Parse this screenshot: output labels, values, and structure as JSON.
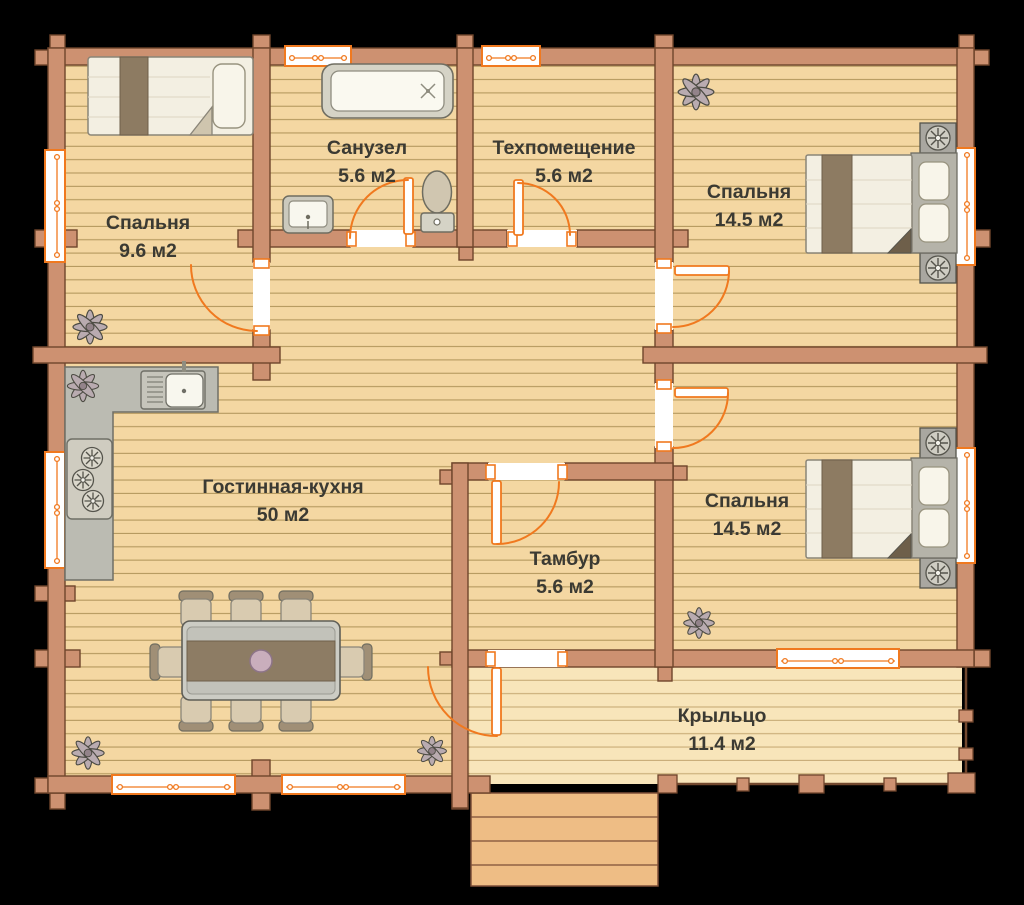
{
  "plan": {
    "rooms": [
      {
        "id": "bedroom-1",
        "name": "Спальня",
        "area": "9.6 м2"
      },
      {
        "id": "bathroom",
        "name": "Санузел",
        "area": "5.6 м2"
      },
      {
        "id": "tech-room",
        "name": "Техпомещение",
        "area": "5.6 м2"
      },
      {
        "id": "bedroom-2",
        "name": "Спальня",
        "area": "14.5 м2"
      },
      {
        "id": "living-kitchen",
        "name": "Гостинная-кухня",
        "area": "50 м2"
      },
      {
        "id": "vestibule",
        "name": "Тамбур",
        "area": "5.6 м2"
      },
      {
        "id": "bedroom-3",
        "name": "Спальня",
        "area": "14.5 м2"
      },
      {
        "id": "porch",
        "name": "Крыльцо",
        "area": "11.4 м2"
      }
    ],
    "colors": {
      "wall": "#cd9171",
      "wall_outline": "#6f452c",
      "floor": "#f4d7a2",
      "floor_line": "#a5894f",
      "porch_floor": "#f8e5ba",
      "steps": "#eebd85",
      "accent_orange": "#f0791f",
      "furniture_gray": "#c6c5bb",
      "label_text": "#3b3a33"
    }
  }
}
